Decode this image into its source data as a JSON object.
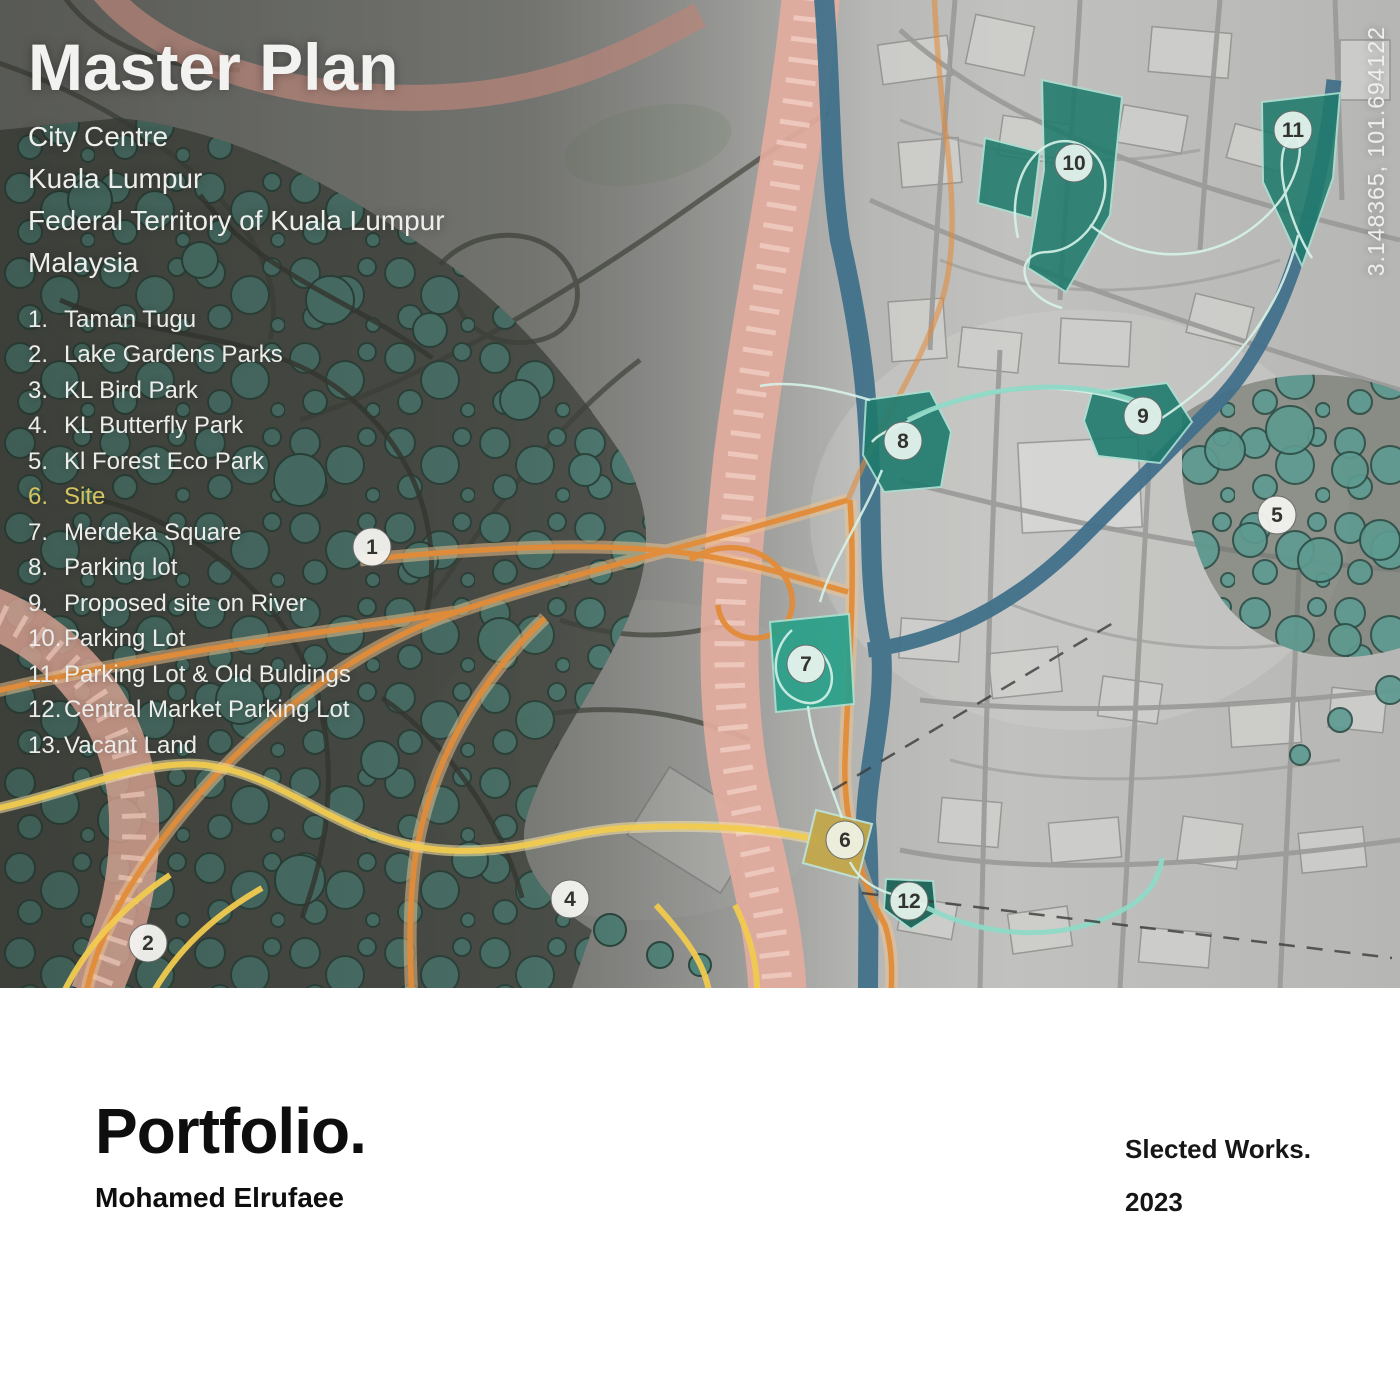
{
  "map": {
    "title": "Master Plan",
    "subtitle_lines": [
      "City Centre",
      "Kuala Lumpur",
      "Federal Territory of Kuala Lumpur",
      "Malaysia"
    ],
    "coordinates": "3.148365, 101.694122",
    "legend": {
      "items": [
        {
          "num": "1.",
          "label": "Taman Tugu"
        },
        {
          "num": "2.",
          "label": "Lake Gardens Parks"
        },
        {
          "num": "3.",
          "label": "KL Bird Park"
        },
        {
          "num": "4.",
          "label": "KL Butterfly Park"
        },
        {
          "num": "5.",
          "label": "Kl Forest Eco Park"
        },
        {
          "num": "6.",
          "label": "Site"
        },
        {
          "num": "7.",
          "label": "Merdeka Square"
        },
        {
          "num": "8.",
          "label": "Parking lot"
        },
        {
          "num": "9.",
          "label": "Proposed site on River"
        },
        {
          "num": "10.",
          "label": "Parking Lot"
        },
        {
          "num": "11.",
          "label": "Parking Lot & Old Buldings"
        },
        {
          "num": "12.",
          "label": "Central Market Parking Lot"
        },
        {
          "num": "13.",
          "label": "Vacant Land"
        }
      ]
    },
    "markers": [
      {
        "number": "1"
      },
      {
        "number": "2"
      },
      {
        "number": "4"
      },
      {
        "number": "5"
      },
      {
        "number": "6"
      },
      {
        "number": "7"
      },
      {
        "number": "8"
      },
      {
        "number": "9"
      },
      {
        "number": "10"
      },
      {
        "number": "11"
      },
      {
        "number": "12"
      }
    ]
  },
  "footer": {
    "title": "Portfolio.",
    "author": "Mohamed Elrufaee",
    "works": "Slected Works.",
    "year": "2023"
  },
  "colors": {
    "site-teal": "#1f7a6d",
    "site-teal-bright": "#2aa089",
    "site-teal-dark": "#176055",
    "site-yellow": "#c2a74b",
    "tree-green": "#5d9a90",
    "river-blue": "#41718a",
    "corridor-pink": "#e3ac9e",
    "road-orange": "#e28c38",
    "route-yellow": "#f1cb50",
    "route-mint": "#8fd9c6",
    "legend-site-label": "#d6c55e",
    "marker-bg": "#f4f4f1"
  }
}
